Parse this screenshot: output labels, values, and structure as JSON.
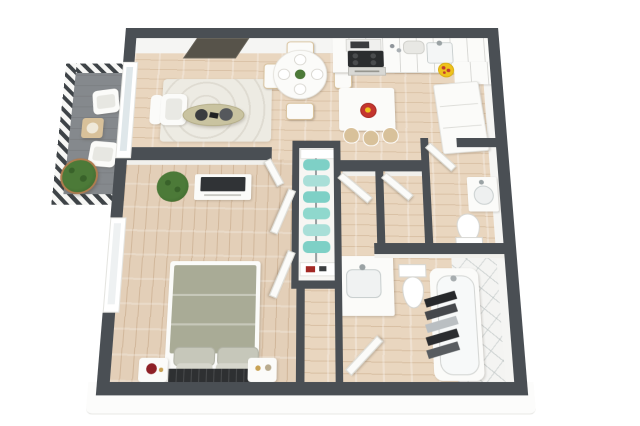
{
  "image": {
    "type": "3d-floor-plan",
    "description": "Top-down 3D rendered floor plan of a one-bedroom apartment with balcony, on a plain white background, no text labels",
    "background": "#ffffff"
  },
  "colors": {
    "wall": "#4a4f54",
    "wallFace": "#f5f5f3",
    "wood": "#e9d6bf",
    "bedWood": "#e3cfb8",
    "balconyFloor": "#85898d",
    "hatchDark": "#3e4347",
    "rug": "#edebe3",
    "white": "#fbfbf9",
    "duvet": "#a9ab96",
    "pillow": "#c6c7ba",
    "pillowLight": "#d6d6cc",
    "throwDark": "#2e3032",
    "tv": "#303336",
    "tvWall": "#57534a",
    "plant": "#4c7a38",
    "plantDark": "#39622a",
    "pot": "#b07c4f",
    "teal": "#7ed0c6",
    "tealLight": "#a9dfd8",
    "yellow": "#eec21d",
    "red": "#c4352e",
    "olive": "#c9c3a0",
    "tan": "#d8c19a",
    "tile": "#f4f4f2",
    "glass": "#dfe7ea",
    "slab": "#fcfcfb",
    "lampRed": "#8e2026"
  },
  "scene": {
    "rooms": [
      {
        "name": "balcony",
        "furniture": [
          "lounge-chair",
          "lounge-chair",
          "cube-side-table",
          "potted-plant",
          "hatched-railing"
        ]
      },
      {
        "name": "living-room",
        "furniture": [
          "wall-tv",
          "area-rug",
          "armchair",
          "oval-coffee-table",
          "decor-trays",
          "sliding-glass-door"
        ]
      },
      {
        "name": "dining-area",
        "furniture": [
          "round-table",
          "dining-chairs-4",
          "place-settings-4",
          "centerpiece-plant"
        ]
      },
      {
        "name": "kitchen",
        "furniture": [
          "cabinets-counter",
          "microwave",
          "cooktop-oven",
          "sink",
          "bread-box",
          "refrigerator",
          "island",
          "bar-stools-3",
          "fruit-bowl",
          "sunflower-decal"
        ]
      },
      {
        "name": "hallway",
        "furniture": [
          "storage-closet-with-door",
          "storage-closet-with-door"
        ]
      },
      {
        "name": "wardrobe-closet",
        "furniture": [
          "hanging-clothes-rack",
          "shelves",
          "shoes"
        ]
      },
      {
        "name": "powder-room",
        "furniture": [
          "door",
          "corner-sink",
          "toilet"
        ]
      },
      {
        "name": "bathroom",
        "furniture": [
          "door",
          "vanity-sink",
          "toilet",
          "bathtub",
          "towels",
          "tiled-shower-area"
        ]
      },
      {
        "name": "bedroom",
        "furniture": [
          "double-bed",
          "pillows",
          "dark-throw",
          "nightstand",
          "nightstand",
          "red-table-lamp",
          "media-console",
          "tv",
          "potted-plant",
          "window",
          "bifold-closet-doors",
          "door"
        ]
      }
    ]
  }
}
